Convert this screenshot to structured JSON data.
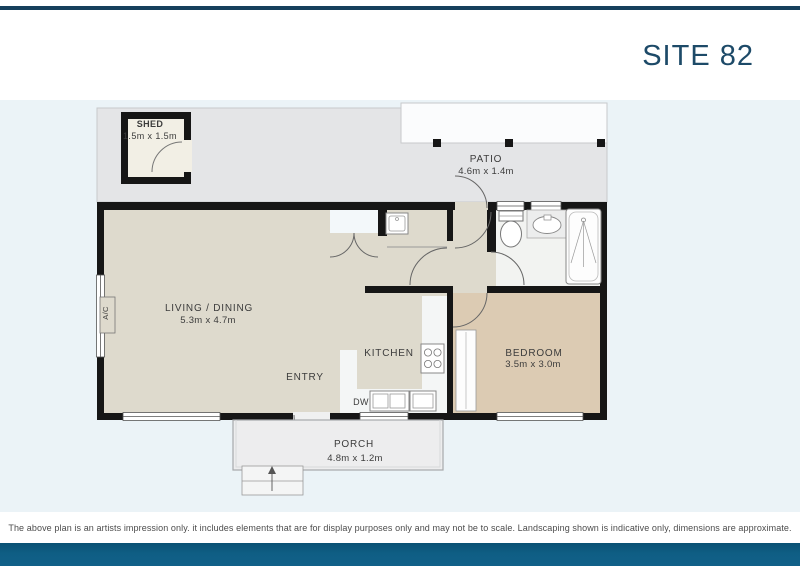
{
  "header": {
    "site_label": "SITE 82"
  },
  "floor_plan": {
    "rooms": [
      {
        "id": "shed",
        "name": "SHED",
        "dimensions": "1.5m x 1.5m"
      },
      {
        "id": "patio",
        "name": "PATIO",
        "dimensions": "4.6m x 1.4m"
      },
      {
        "id": "living-dining",
        "name": "LIVING / DINING",
        "dimensions": "5.3m x 4.7m"
      },
      {
        "id": "kitchen",
        "name": "KITCHEN",
        "dimensions": ""
      },
      {
        "id": "entry",
        "name": "ENTRY",
        "dimensions": ""
      },
      {
        "id": "bedroom",
        "name": "BEDROOM",
        "dimensions": "3.5m x 3.0m"
      },
      {
        "id": "porch",
        "name": "PORCH",
        "dimensions": "4.8m x 1.2m"
      }
    ],
    "annotations": {
      "dishwasher": "DW",
      "air_conditioning": "A/C"
    },
    "fixture_icons": [
      "toilet-icon",
      "basin-icon",
      "shower-icon",
      "stove-icon",
      "sink-icon",
      "dishwasher-icon",
      "laundry-tub-icon",
      "wardrobe-icon",
      "stairs-up-icon",
      "door-swing-icon"
    ]
  },
  "footer": {
    "disclaimer": "The above plan is an artists impression only. it includes elements that are for display purposes only and may not be to scale. Landscaping shown is indicative only, dimensions are approximate."
  },
  "colors": {
    "brand_bar_top": "#16405c",
    "brand_bar_bottom": "#0f5e84",
    "site_label_text": "#1d4a68",
    "plan_background": "#ebf3f7",
    "floor_main": "#dedacd",
    "floor_bedroom": "#dccbb3",
    "floor_bathroom": "#f2f3f1",
    "yard": "#e4e5e7",
    "wall": "#161616"
  }
}
